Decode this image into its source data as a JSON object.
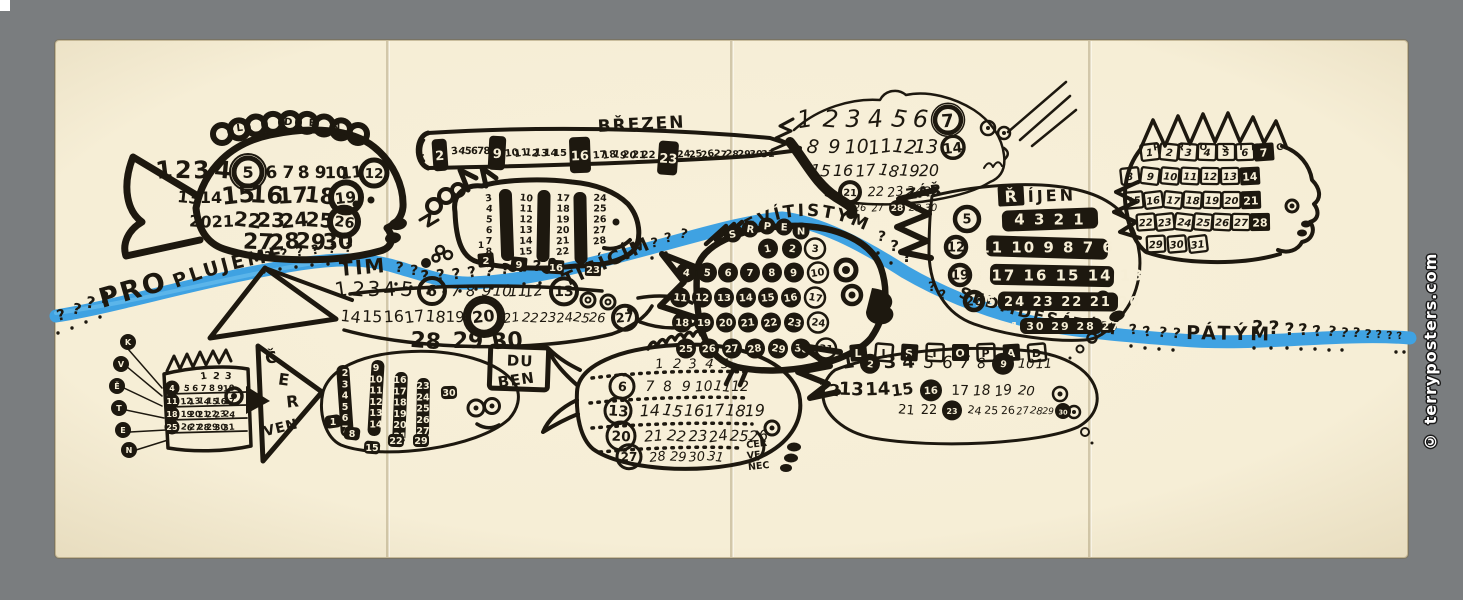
{
  "poster": {
    "watermark": "© terryposters.com",
    "colors": {
      "border": "#7a7d7f",
      "paper": "#f6eed6",
      "paper_edge": "#e7dcbe",
      "ink": "#1d180f",
      "river_blue": "#3fa2e2",
      "watermark_text": "#ffffff"
    },
    "sentence": {
      "full_text": "PROPLUJEME ???? TÍM ?? TISÍCÍM ??? DEVÍTISTÝM ??? SEDMDESÁTÝM ???? PÁTÝM ??????????",
      "question_mark": "?",
      "words": {
        "pro": "PRO",
        "plujeme": "PLUJEME",
        "tim": "TÍM",
        "tisicim": "TISÍCÍM",
        "devitistym": "DEVÍTISTÝM",
        "sedmdesatym": "SEDMDESÁTÝM",
        "patym": "PÁTÝM"
      }
    },
    "months": [
      {
        "id": "leden",
        "name": "LEDEN",
        "rows": [
          [
            "1",
            "2",
            "3",
            "4",
            "5",
            "6",
            "7",
            "8",
            "9",
            "10",
            "11",
            "12"
          ],
          [
            "13",
            "14",
            "15",
            "16",
            "17",
            "18",
            "19"
          ],
          [
            "20",
            "21",
            "22",
            "23",
            "24",
            "25",
            "26"
          ],
          [
            "27",
            "28",
            "29",
            "30"
          ]
        ],
        "sundays": [
          "5",
          "12",
          "19",
          "26"
        ]
      },
      {
        "id": "unor",
        "name": "ÚNOR",
        "first_day": "1",
        "cols": [
          [
            "3",
            "4",
            "5",
            "6",
            "7",
            "8"
          ],
          [
            "10",
            "11",
            "12",
            "13",
            "14",
            "15"
          ],
          [
            "17",
            "18",
            "19",
            "20",
            "21",
            "22"
          ],
          [
            "24",
            "25",
            "26",
            "27",
            "28"
          ]
        ],
        "sundays": [
          "2",
          "9",
          "16",
          "23"
        ]
      },
      {
        "id": "brezen",
        "name": "BŘEZEN",
        "rows": [
          [
            "1"
          ],
          [
            "3",
            "4",
            "5",
            "6",
            "7",
            "8"
          ],
          [
            "10",
            "11",
            "12",
            "13",
            "14",
            "15"
          ],
          [
            "17",
            "18",
            "19",
            "20",
            "21",
            "22"
          ],
          [
            "24",
            "25",
            "26",
            "27",
            "28",
            "29",
            "30",
            "31"
          ]
        ],
        "sundays": [
          "2",
          "9",
          "16",
          "23"
        ]
      },
      {
        "id": "duben",
        "name": "DUBEN",
        "label_lines": [
          "DU",
          "BEN"
        ],
        "rows": [
          [
            "1",
            "2",
            "3",
            "4",
            "5",
            "6",
            "7",
            "8",
            "9",
            "10",
            "11",
            "12",
            "13"
          ],
          [
            "14",
            "15",
            "16",
            "17",
            "18",
            "19",
            "20",
            "21",
            "22",
            "23",
            "24",
            "25",
            "26",
            "27"
          ],
          [
            "28",
            "29",
            "30"
          ]
        ],
        "sundays": [
          "6",
          "13",
          "20",
          "27"
        ]
      },
      {
        "id": "kveten",
        "name": "KVĚTEN",
        "label_letters": [
          "K",
          "V",
          "Ě",
          "T",
          "E",
          "N"
        ],
        "top_row": [
          "1",
          "2",
          "3"
        ],
        "rows": [
          [
            "4",
            "5",
            "6",
            "7",
            "8",
            "9",
            "10"
          ],
          [
            "11",
            "12",
            "13",
            "14",
            "15",
            "16",
            "17"
          ],
          [
            "18",
            "19",
            "20",
            "21",
            "22",
            "23",
            "24"
          ],
          [
            "25",
            "26",
            "27",
            "28",
            "29",
            "30",
            "31"
          ]
        ],
        "sundays": [
          "4",
          "11",
          "18",
          "25"
        ]
      },
      {
        "id": "cerven",
        "name": "ČERVEN",
        "label_lines": [
          "Č",
          "E",
          "R",
          "VEN"
        ],
        "cols": [
          [
            "2",
            "3",
            "4",
            "5",
            "6",
            "7"
          ],
          [
            "9",
            "10",
            "11",
            "12",
            "13",
            "14"
          ],
          [
            "16",
            "17",
            "18",
            "19",
            "20",
            "21"
          ],
          [
            "23",
            "24",
            "25",
            "26",
            "27",
            "28"
          ]
        ],
        "boxed": [
          "1",
          "8",
          "15",
          "22",
          "29",
          "30"
        ],
        "sundays": [
          "1",
          "8",
          "15",
          "22",
          "29"
        ]
      },
      {
        "id": "cervenec",
        "name": "ČERVENEC",
        "label_lines": [
          "ČER",
          "VE",
          "NEC"
        ],
        "rows": [
          [
            "1",
            "2",
            "3",
            "4",
            "5"
          ],
          [
            "6",
            "7",
            "8",
            "9",
            "10",
            "11",
            "12"
          ],
          [
            "13",
            "14",
            "15",
            "16",
            "17",
            "18",
            "19"
          ],
          [
            "20",
            "21",
            "22",
            "23",
            "24",
            "25",
            "26"
          ],
          [
            "27",
            "28",
            "29",
            "30",
            "31"
          ]
        ],
        "sundays": [
          "6",
          "13",
          "20",
          "27"
        ]
      },
      {
        "id": "srpen",
        "name": "SRPEN",
        "rows": [
          [
            "1",
            "2",
            "3"
          ],
          [
            "4",
            "5",
            "6",
            "7",
            "8",
            "9",
            "10"
          ],
          [
            "11",
            "12",
            "13",
            "14",
            "15",
            "16",
            "17"
          ],
          [
            "18",
            "19",
            "20",
            "21",
            "22",
            "23",
            "24"
          ],
          [
            "25",
            "26",
            "27",
            "28",
            "29",
            "30",
            "31"
          ]
        ],
        "sundays": [
          "3",
          "10",
          "17",
          "24",
          "31"
        ]
      },
      {
        "id": "zari",
        "name": "ZÁŘÍ",
        "label_short": "ZÁŘ",
        "rows": [
          [
            "1",
            "2",
            "3",
            "4",
            "5",
            "6",
            "7"
          ],
          [
            "8",
            "9",
            "10",
            "11",
            "12",
            "13",
            "14"
          ],
          [
            "15",
            "16",
            "17",
            "18",
            "19",
            "20"
          ],
          [
            "21",
            "22",
            "23",
            "24",
            "25"
          ],
          [
            "26",
            "27",
            "28",
            "29",
            "30"
          ]
        ],
        "sundays": [
          "7",
          "14",
          "21",
          "28"
        ]
      },
      {
        "id": "rijen",
        "name": "ŘÍJEN",
        "rows": [
          [
            "4",
            "3",
            "2",
            "1"
          ],
          [
            "11",
            "10",
            "9",
            "8",
            "7",
            "6"
          ],
          [
            "18",
            "17",
            "16",
            "15",
            "14",
            "13"
          ],
          [
            "25",
            "24",
            "23",
            "22",
            "21",
            "20"
          ],
          [
            "31",
            "30",
            "29",
            "28",
            "27"
          ]
        ],
        "sundays": [
          "5",
          "12",
          "19",
          "26"
        ]
      },
      {
        "id": "listopad",
        "name": "LISTOPAD",
        "rows": [
          [
            "1",
            "2",
            "3",
            "4",
            "5",
            "6",
            "7",
            "8",
            "9",
            "10",
            "11"
          ],
          [
            "12",
            "13",
            "14",
            "15",
            "16",
            "17",
            "18",
            "19",
            "20"
          ],
          [
            "21",
            "22",
            "23",
            "24",
            "25",
            "26",
            "27",
            "28",
            "29",
            "30"
          ]
        ],
        "sundays": [
          "2",
          "9",
          "16",
          "23",
          "30"
        ]
      },
      {
        "id": "prosinec",
        "name": "PROSINEC",
        "rows": [
          [
            "1",
            "2",
            "3",
            "4",
            "5",
            "6",
            "7"
          ],
          [
            "8",
            "9",
            "10",
            "11",
            "12",
            "13",
            "14"
          ],
          [
            "15",
            "16",
            "17",
            "18",
            "19",
            "20",
            "21"
          ],
          [
            "22",
            "23",
            "24",
            "25",
            "26",
            "27",
            "28"
          ],
          [
            "29",
            "30",
            "31"
          ]
        ],
        "sundays": [
          "7",
          "14",
          "21",
          "28"
        ]
      }
    ]
  }
}
